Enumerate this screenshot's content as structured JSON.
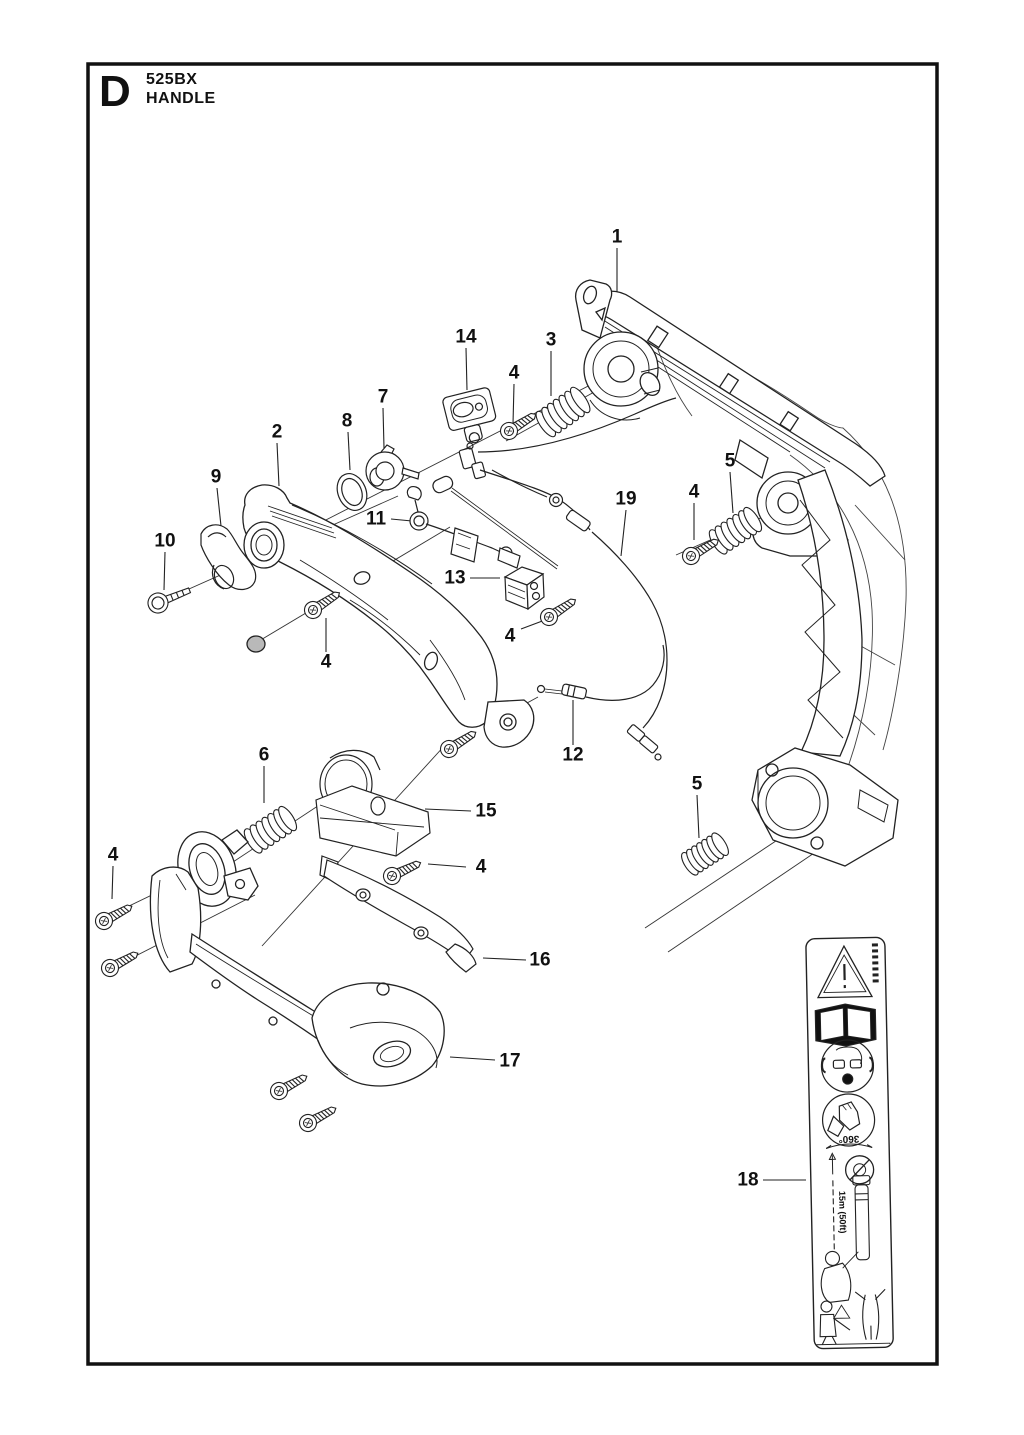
{
  "page": {
    "frame_letter": "D",
    "model": "525BX",
    "section_title": "HANDLE"
  },
  "callouts": [
    "1",
    "14",
    "3",
    "4",
    "7",
    "8",
    "2",
    "9",
    "10",
    "11",
    "19",
    "4",
    "5",
    "13",
    "4",
    "4",
    "12",
    "6",
    "15",
    "4",
    "4",
    "16",
    "17",
    "5",
    "18"
  ],
  "sticker": {
    "rotation_text": "360°",
    "distance_text": "15m (50ft)",
    "icons": [
      "warning-triangle",
      "read-operators-manual",
      "hearing-eye-breathing-protection",
      "protective-gloves",
      "360-degree-sweep-arc",
      "bystander-prohibition",
      "blower-operator-figure",
      "bystander-distance-scene"
    ]
  }
}
